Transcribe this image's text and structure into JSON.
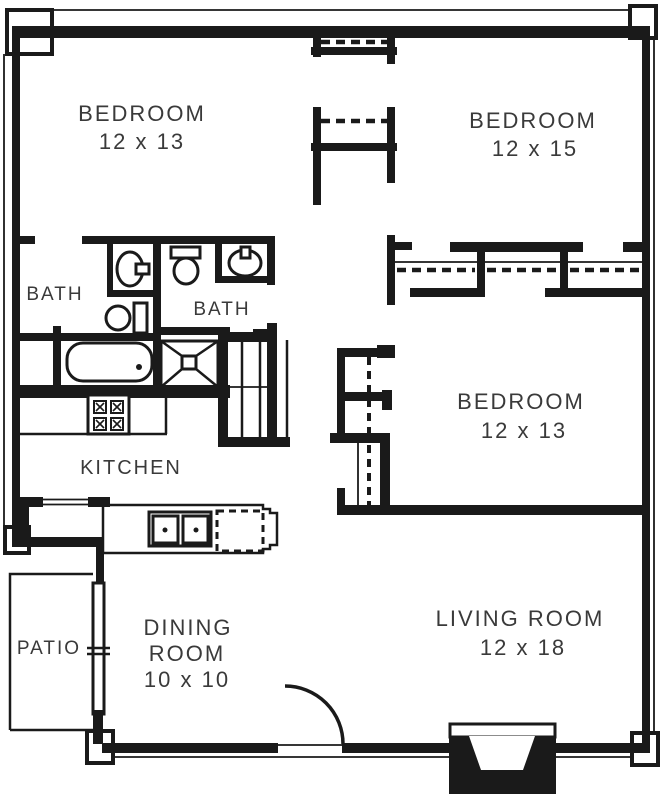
{
  "plan": {
    "type": "apartment-floor-plan",
    "colors": {
      "wall": "#1a1a1a",
      "text": "#3a3a3a",
      "background": "#ffffff"
    },
    "rooms": {
      "bedroom_top_left": {
        "label": "BEDROOM",
        "dims": "12 x 13"
      },
      "bedroom_top_right": {
        "label": "BEDROOM",
        "dims": "12 x 15"
      },
      "bedroom_mid_right": {
        "label": "BEDROOM",
        "dims": "12 x 13"
      },
      "living_room": {
        "label": "LIVING ROOM",
        "dims": "12 x 18"
      },
      "dining_room": {
        "label1": "DINING",
        "label2": "ROOM",
        "dims": "10 x 10"
      },
      "kitchen": {
        "label": "KITCHEN"
      },
      "bath_left": {
        "label": "BATH"
      },
      "bath_right": {
        "label": "BATH"
      },
      "patio": {
        "label": "PATIO"
      }
    },
    "fixtures": {
      "bath_left": [
        "sink",
        "toilet",
        "bathtub"
      ],
      "bath_right": [
        "toilet",
        "sink"
      ],
      "kitchen": [
        "stove",
        "double-sink",
        "dishwasher-dashed"
      ],
      "living_room": [
        "fireplace",
        "entry-door-arc"
      ],
      "patio": [
        "sliding-glass-door"
      ],
      "closets": [
        "bedroom-closet-rods-dashed",
        "louvered-linen-closet",
        "hall-closet"
      ]
    }
  }
}
